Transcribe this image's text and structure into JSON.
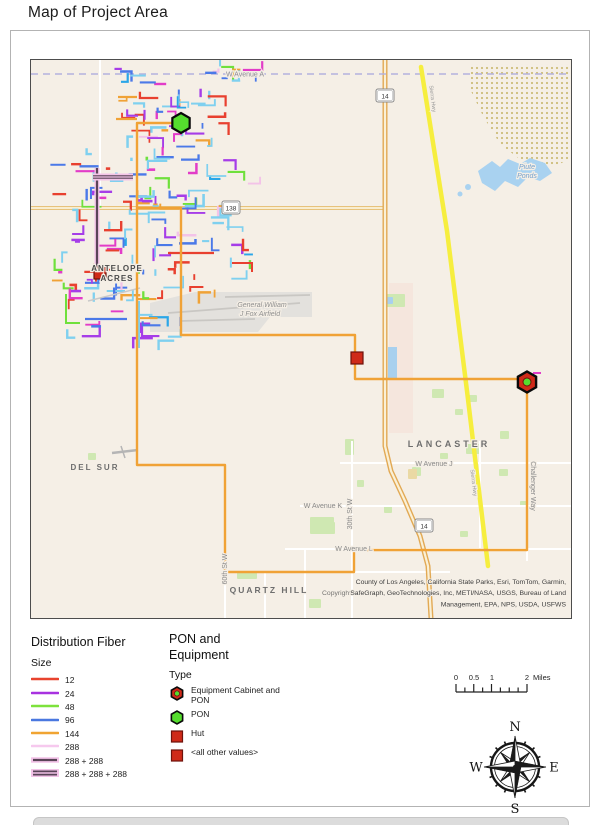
{
  "page": {
    "title": "Map of Project Area"
  },
  "legend_fiber": {
    "title": "Distribution Fiber",
    "subtitle": "Size",
    "items": [
      {
        "label": "12",
        "style": "solid",
        "color": "#e8432e"
      },
      {
        "label": "24",
        "style": "solid",
        "color": "#a832e0"
      },
      {
        "label": "48",
        "style": "solid",
        "color": "#7de23c"
      },
      {
        "label": "96",
        "style": "solid",
        "color": "#4a78e0"
      },
      {
        "label": "144",
        "style": "solid",
        "color": "#f0a432"
      },
      {
        "label": "288",
        "style": "solid",
        "color": "#f6c9ee"
      },
      {
        "label": "288 + 288",
        "style": "double",
        "color": "#5a4458"
      },
      {
        "label": "288 + 288 + 288",
        "style": "triple",
        "color": "#5a4458"
      }
    ]
  },
  "legend_equipment": {
    "title": "PON and Equipment",
    "subtitle": "Type",
    "items": [
      {
        "label": "Equipment Cabinet and PON",
        "icon": "cab-pon"
      },
      {
        "label": "PON",
        "icon": "pon"
      },
      {
        "label": "Hut",
        "icon": "hut"
      },
      {
        "label": "<all other values>",
        "icon": "hut"
      }
    ]
  },
  "scalebar": {
    "ticks": [
      "0",
      "0.5",
      "1",
      "2"
    ],
    "unit": "Miles"
  },
  "compass": {
    "n": "N",
    "s": "S",
    "e": "E",
    "w": "W"
  },
  "map": {
    "bg": "#f5efe6",
    "seed": 42,
    "palette": [
      [
        "#7fd0ef",
        30
      ],
      [
        "#e8402f",
        18
      ],
      [
        "#a63de8",
        12
      ],
      [
        "#4b79e8",
        13
      ],
      [
        "#6fe03c",
        7
      ],
      [
        "#f0a236",
        8
      ],
      [
        "#e23cc8",
        5
      ],
      [
        "#f3c3e8",
        4
      ],
      [
        "#2aa6e8",
        3
      ]
    ],
    "clusters": [
      {
        "x": 118,
        "y": 64,
        "w": 102,
        "h": 76,
        "n": 42
      },
      {
        "x": 214,
        "y": 64,
        "w": 52,
        "h": 24,
        "n": 8
      },
      {
        "x": 62,
        "y": 145,
        "w": 188,
        "h": 150,
        "n": 118
      },
      {
        "x": 62,
        "y": 295,
        "w": 120,
        "h": 45,
        "n": 22
      }
    ],
    "accents": [
      {
        "pts": [
          [
            97,
            167
          ],
          [
            97,
            268
          ]
        ],
        "style": "double"
      },
      {
        "pts": [
          [
            93,
            176
          ],
          [
            133,
            176
          ]
        ],
        "style": "triple"
      },
      {
        "pts": [
          [
            139,
            300
          ],
          [
            139,
            347
          ]
        ],
        "color": "#7fd0ef",
        "w": 2
      },
      {
        "pts": [
          [
            85,
            318
          ],
          [
            127,
            318
          ]
        ],
        "color": "#4b79e8",
        "w": 2.2
      },
      {
        "pts": [
          [
            66,
            293
          ],
          [
            66,
            322
          ],
          [
            80,
            322
          ]
        ],
        "color": "#6fe03c",
        "w": 2
      },
      {
        "pts": [
          [
            168,
            252
          ],
          [
            214,
            252
          ]
        ],
        "color": "#e8402f",
        "w": 2.2
      },
      {
        "pts": [
          [
            232,
            262
          ],
          [
            252,
            262
          ],
          [
            252,
            271
          ]
        ],
        "color": "#e8402f",
        "w": 2
      },
      {
        "pts": [
          [
            118,
            96
          ],
          [
            137,
            96
          ]
        ],
        "color": "#f0a236",
        "w": 2.2
      },
      {
        "pts": [
          [
            116,
            118
          ],
          [
            137,
            118
          ]
        ],
        "color": "#f0a236",
        "w": 2.2
      },
      {
        "pts": [
          [
            533,
            372
          ],
          [
            541,
            372
          ]
        ],
        "color": "#e23cc8",
        "w": 2
      },
      {
        "pts": [
          [
            88,
            300
          ],
          [
            140,
            287
          ]
        ],
        "color": "#c9c9c9",
        "w": 1.5
      },
      {
        "pts": [
          [
            112,
            452
          ],
          [
            138,
            449
          ]
        ],
        "color": "#b5b5b5",
        "w": 2.5
      },
      {
        "pts": [
          [
            121,
            445
          ],
          [
            125,
            457
          ]
        ],
        "color": "#b5b5b5",
        "w": 1.5
      }
    ],
    "backbone": {
      "color": "#f0a236",
      "width": 2.4,
      "routes": [
        [
          [
            181,
            122
          ],
          [
            137,
            122
          ],
          [
            137,
            464
          ],
          [
            225,
            464
          ],
          [
            225,
            571
          ],
          [
            354,
            571
          ],
          [
            354,
            549
          ],
          [
            527,
            549
          ],
          [
            527,
            381
          ]
        ],
        [
          [
            137,
            207
          ],
          [
            181,
            207
          ],
          [
            181,
            334
          ],
          [
            355,
            334
          ],
          [
            355,
            378
          ],
          [
            527,
            378
          ]
        ]
      ]
    },
    "markers": {
      "pon": {
        "x": 181,
        "y": 122,
        "r": 10
      },
      "cab": {
        "x": 527,
        "y": 381,
        "r": 10.5
      },
      "huts": [
        {
          "x": 100,
          "y": 272,
          "s": 12
        },
        {
          "x": 357,
          "y": 357,
          "s": 12
        }
      ],
      "colors": {
        "red": "#cf2a19",
        "red_dark": "#6e120b",
        "green": "#55dd2e",
        "outline": "#0a0a0a"
      }
    },
    "avenue_a": {
      "y": 73,
      "color": "#b4b2dd"
    },
    "hwy14": [
      [
        385,
        59
      ],
      [
        385,
        445
      ],
      [
        391,
        470
      ],
      [
        405,
        500
      ],
      [
        420,
        535
      ],
      [
        428,
        565
      ],
      [
        431,
        617
      ]
    ],
    "hwy138": [
      [
        31,
        207
      ],
      [
        385,
        207
      ]
    ],
    "yellow_line": {
      "pts": [
        [
          421,
          66
        ],
        [
          447,
          230
        ],
        [
          467,
          390
        ],
        [
          488,
          565
        ]
      ],
      "color": "#f6ee3e",
      "w": 4.5
    },
    "roads": [
      [
        100,
        59,
        100,
        207
      ],
      [
        137,
        122,
        137,
        464
      ],
      [
        181,
        207,
        181,
        334
      ],
      [
        352,
        440,
        352,
        617
      ],
      [
        305,
        548,
        305,
        617
      ],
      [
        225,
        545,
        225,
        617
      ],
      [
        480,
        440,
        480,
        548
      ],
      [
        527,
        378,
        527,
        560
      ],
      [
        340,
        462,
        571,
        462
      ],
      [
        300,
        505,
        571,
        505
      ],
      [
        285,
        548,
        571,
        548
      ],
      [
        225,
        571,
        450,
        571
      ],
      [
        265,
        571,
        265,
        617
      ]
    ],
    "military": [
      [
        468,
        63
      ],
      [
        571,
        63
      ],
      [
        571,
        158
      ],
      [
        552,
        166
      ],
      [
        522,
        160
      ],
      [
        500,
        143
      ],
      [
        483,
        115
      ],
      [
        470,
        88
      ]
    ],
    "water": {
      "pond": [
        [
          478,
          170
        ],
        [
          492,
          160
        ],
        [
          500,
          166
        ],
        [
          508,
          158
        ],
        [
          520,
          163
        ],
        [
          530,
          157
        ],
        [
          545,
          162
        ],
        [
          552,
          172
        ],
        [
          540,
          180
        ],
        [
          528,
          176
        ],
        [
          518,
          186
        ],
        [
          505,
          180
        ],
        [
          495,
          190
        ],
        [
          482,
          182
        ]
      ],
      "blobs": [
        [
          468,
          186,
          3
        ],
        [
          460,
          193,
          2.5
        ]
      ],
      "color": "#a9d2f0"
    },
    "airfield": {
      "poly": [
        [
          150,
          302
        ],
        [
          195,
          291
        ],
        [
          312,
          291
        ],
        [
          312,
          316
        ],
        [
          270,
          316
        ],
        [
          258,
          331
        ],
        [
          150,
          331
        ]
      ],
      "fill": "#e3e1dd",
      "runways": [
        [
          168,
          312,
          300,
          302
        ],
        [
          180,
          320,
          255,
          318
        ],
        [
          225,
          296,
          310,
          294
        ]
      ]
    },
    "pink_strip": [
      389,
      282,
      24,
      150
    ],
    "blue_rect": [
      388,
      346,
      9,
      31
    ],
    "green_blob": [
      383,
      293,
      22,
      13
    ],
    "small_blue": [
      386,
      296,
      7,
      7
    ],
    "tan_patch": [
      408,
      468,
      9,
      10
    ],
    "patches": [
      [
        432,
        388,
        12,
        9
      ],
      [
        468,
        394,
        9,
        7
      ],
      [
        345,
        438,
        9,
        16
      ],
      [
        466,
        443,
        14,
        10
      ],
      [
        500,
        430,
        9,
        8
      ],
      [
        412,
        466,
        9,
        9
      ],
      [
        384,
        504,
        8,
        8
      ],
      [
        310,
        516,
        24,
        17
      ],
      [
        357,
        479,
        7,
        7
      ],
      [
        313,
        521,
        22,
        12
      ],
      [
        237,
        571,
        20,
        7
      ],
      [
        309,
        598,
        12,
        9
      ],
      [
        88,
        452,
        8,
        7
      ],
      [
        455,
        408,
        8,
        6
      ],
      [
        440,
        452,
        8,
        6
      ],
      [
        499,
        468,
        9,
        7
      ],
      [
        520,
        500,
        8,
        6
      ],
      [
        460,
        530,
        8,
        6
      ]
    ],
    "patch_color": "#cfe8b2",
    "shields": [
      {
        "text": "14",
        "x": 385,
        "y": 95
      },
      {
        "text": "138",
        "x": 231,
        "y": 207
      },
      {
        "text": "14",
        "x": 424,
        "y": 525
      }
    ],
    "labels": [
      {
        "text": "W Avenue A",
        "x": 245,
        "y": 75.5,
        "size": 7,
        "color": "#8a8a96"
      },
      {
        "text": "ANTELOPE",
        "x": 117,
        "y": 270,
        "size": 8,
        "color": "#4a4a4a",
        "bold": true,
        "ls": 1
      },
      {
        "text": "ACRES",
        "x": 117,
        "y": 280,
        "size": 8,
        "color": "#4a4a4a",
        "bold": true,
        "ls": 1
      },
      {
        "text": "DEL SUR",
        "x": 95,
        "y": 469,
        "size": 8,
        "color": "#6e6e6e",
        "bold": true,
        "ls": 2
      },
      {
        "text": "LANCASTER",
        "x": 449,
        "y": 446,
        "size": 9,
        "color": "#6e6e6e",
        "bold": true,
        "ls": 3
      },
      {
        "text": "QUARTZ HILL",
        "x": 269,
        "y": 592,
        "size": 8.5,
        "color": "#6e6e6e",
        "bold": true,
        "ls": 2
      },
      {
        "text": "W Avenue J",
        "x": 434,
        "y": 465,
        "size": 7,
        "color": "#8a8a8a"
      },
      {
        "text": "W Avenue K",
        "x": 323,
        "y": 507,
        "size": 7,
        "color": "#8a8a8a"
      },
      {
        "text": "W Avenue L",
        "x": 354,
        "y": 550,
        "size": 7,
        "color": "#8a8a8a"
      },
      {
        "text": "30th St W",
        "x": 352,
        "y": 513,
        "size": 7,
        "color": "#8a8a8a",
        "rot": -90
      },
      {
        "text": "60th St W",
        "x": 227,
        "y": 568,
        "size": 7,
        "color": "#8a8a8a",
        "rot": -90
      },
      {
        "text": "Challenger Way",
        "x": 531,
        "y": 485,
        "size": 7,
        "color": "#8a8a8a",
        "rot": 90
      },
      {
        "text": "Sierra Hwy",
        "x": 431,
        "y": 98,
        "size": 5.5,
        "color": "#9a9a9a",
        "rot": 83
      },
      {
        "text": "Sierra Hwy",
        "x": 472,
        "y": 482,
        "size": 5.5,
        "color": "#9a9a9a",
        "rot": 83
      },
      {
        "text": "General William",
        "x": 262,
        "y": 306,
        "size": 7,
        "color": "#8f8f8f",
        "italic": true
      },
      {
        "text": "J Fox Airfield",
        "x": 260,
        "y": 315,
        "size": 7,
        "color": "#8f8f8f",
        "italic": true
      },
      {
        "text": "Piute",
        "x": 527,
        "y": 168,
        "size": 7,
        "color": "#74a0cc",
        "italic": true
      },
      {
        "text": "Ponds",
        "x": 527,
        "y": 177,
        "size": 7,
        "color": "#74a0cc",
        "italic": true
      }
    ],
    "attribution": [
      "County of Los Angeles, California State Parks, Esri, TomTom, Garmin,",
      "SafeGraph, GeoTechnologies, Inc, METI/NASA, USGS, Bureau of Land",
      "Management, EPA, NPS, USDA, USFWS"
    ],
    "copyright_overlay": "Copyright:"
  }
}
